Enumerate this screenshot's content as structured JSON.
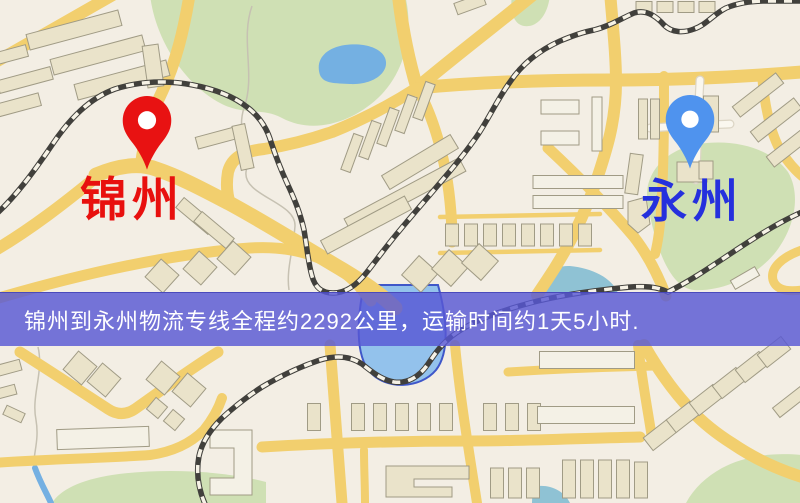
{
  "map": {
    "origin": {
      "label": "锦州",
      "pin_icon": "red-map-pin-icon",
      "label_color": "#e8100e",
      "pin_color": "#e81212"
    },
    "destination": {
      "label": "永州",
      "pin_icon": "blue-map-pin-icon",
      "label_color": "#2530dd",
      "pin_color": "#4f93ee"
    },
    "colors": {
      "land": "#f3eee4",
      "road": "#f2cf6e",
      "park": "#cfe0b4",
      "water": "#74b0e2",
      "building": "#eae3ca",
      "railway": "#41403c"
    }
  },
  "banner": {
    "text": "锦州到永州物流专线全程约2292公里，运输时间约1天5小时.",
    "distance": "约2292公里",
    "duration": "约1天5小时",
    "background_color": "#5858d4",
    "text_color": "#ffffff"
  }
}
